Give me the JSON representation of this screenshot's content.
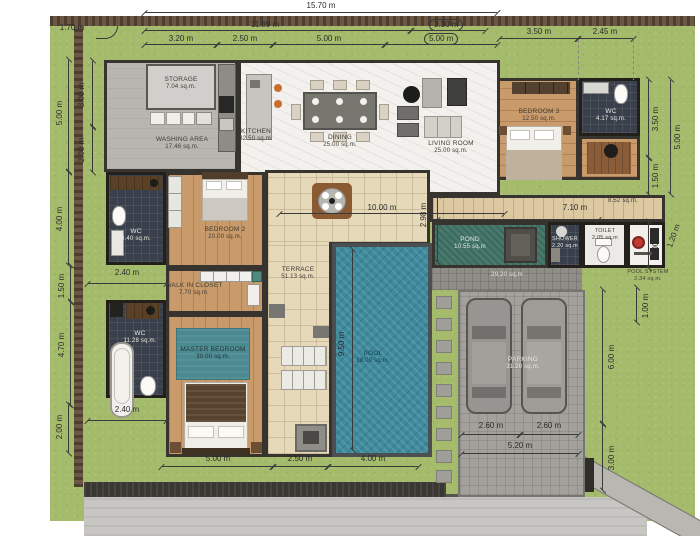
{
  "rooms": {
    "storage": {
      "name": "STORAGE",
      "area": "7.04 sq.m."
    },
    "washing": {
      "name": "WASHING AREA",
      "area": "17.46 sq.m."
    },
    "kitchen": {
      "name": "KITCHEN",
      "area": "32.50 sq.m."
    },
    "dining": {
      "name": "DINING",
      "area": "25.00 sq.m."
    },
    "living": {
      "name": "LIVING ROOM",
      "area": "25.00 sq.m."
    },
    "bedroom3": {
      "name": "BEDROOM 3",
      "area": "12.50 sq.m."
    },
    "wc_top": {
      "name": "WC",
      "area": "4.17 sq.m."
    },
    "bedroom2": {
      "name": "BEDROOM 2",
      "area": "20.00 sq.m."
    },
    "wc_mid": {
      "name": "WC",
      "area": "8.40 sq.m."
    },
    "closet": {
      "name": "WALK IN CLOSET",
      "area": "7.70 sq.m."
    },
    "wc_master": {
      "name": "WC",
      "area": "11.28 sq.m."
    },
    "master": {
      "name": "MASTER BEDROOM",
      "area": "30.00 sq.m."
    },
    "terrace": {
      "name": "TERRACE",
      "area": "51.13 sq.m."
    },
    "pool": {
      "name": "POOL",
      "area": "38.00 sq.m."
    },
    "pond": {
      "name": "POND",
      "area": "10.55 sq.m"
    },
    "shower": {
      "name": "SHOWER",
      "area": "2.20 sq.m"
    },
    "toilet": {
      "name": "TOILET",
      "area": "2.05 sq.m"
    },
    "pool_system": {
      "name": "POOL SYSTEM",
      "area": "2.34 sq.m."
    },
    "parking": {
      "name": "PARKING",
      "area": "31.20 sq.m."
    },
    "walkway": {
      "area": "29.20 sq.m"
    },
    "hallway": {
      "area": "8.52 sq.m."
    }
  },
  "dimensions": {
    "top_total": "15.70 m",
    "top_offset_left": "1.70 m",
    "top_main": "11.89 m",
    "top_wing": "3.30 m",
    "top_a": "3.20 m",
    "top_b": "2.50 m",
    "top_c": "5.00 m",
    "top_d": "5.00 m",
    "top_e": "3.50 m",
    "top_f": "2.45 m",
    "left_a": "3.00 m",
    "left_b": "5.00 m",
    "left_c": "2.00 m",
    "left_d": "4.00 m",
    "left_e": "1.50 m",
    "left_f": "4.70 m",
    "left_g": "2.00 m",
    "wc_mid_w": "2.40 m",
    "wc_master_w": "2.40 m",
    "right_a": "3.50 m",
    "right_b": "1.50 m",
    "right_c": "5.00 m",
    "right_d": "2.00 m",
    "right_e": "1.20 m",
    "right_f": "1.00 m",
    "right_g": "6.00 m",
    "right_h": "3.00 m",
    "terrace_w": "10.00 m",
    "hall_h": "2.98 m",
    "hall_w": "7.10 m",
    "pool_l": "9.50 m",
    "bottom_a": "5.00 m",
    "bottom_b": "2.50 m",
    "bottom_c": "4.00 m",
    "park_a": "2.60 m",
    "park_b": "2.60 m",
    "park_w": "5.20 m",
    "drive_h": "3.00 m"
  },
  "colors": {
    "grass": "#a5bb6c",
    "pool_water": "#3f8b9d",
    "pond_water": "#47796d",
    "wood_floor": "#c99a6a",
    "terrace_tile": "#e5d9ba",
    "dark_tile": "#39404b",
    "pump_red": "#bf3a2f",
    "rug_teal": "#4c8a91"
  }
}
